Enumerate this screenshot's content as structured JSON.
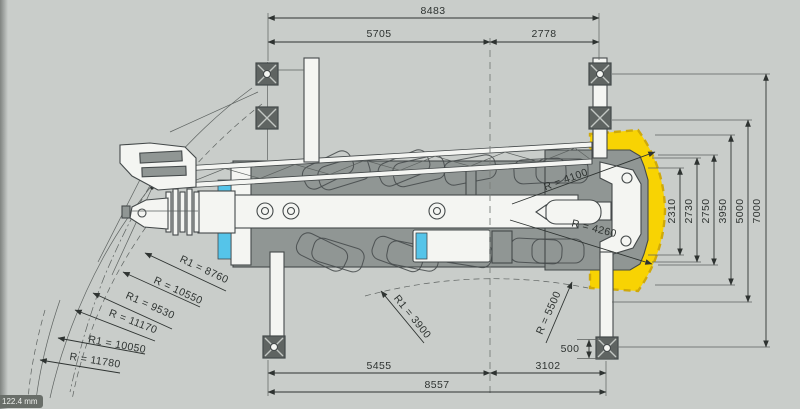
{
  "colors": {
    "background": "#c9cdca",
    "line": "#44494a",
    "text": "#2e3331",
    "body_gray": "#909694",
    "pad_gray": "#5f6462",
    "white_part": "#f4f5f2",
    "accent_yellow": "#f8d303",
    "accent_cyan": "#55c4e9",
    "badge_bg": "#696e69",
    "badge_text": "#eef0ed"
  },
  "dims": {
    "overall_top": "8483",
    "front_top": "5705",
    "rear_top": "2778",
    "bottom_front": "5455",
    "bottom_rear": "3102",
    "bottom_overall": "8557",
    "offset": "500",
    "stack": [
      "2310",
      "2730",
      "2750",
      "3950",
      "5000",
      "7000"
    ]
  },
  "radii": {
    "left": [
      "R1 = 8760",
      "R = 10550",
      "R1 = 9530",
      "R = 11170",
      "R1 = 10050",
      "R = 11780"
    ],
    "center_left": "R1 = 3900",
    "center_right": "R = 5500",
    "tail_upper": "R = 4100",
    "tail_lower": "R = 4260"
  },
  "badge": "122.4 mm"
}
